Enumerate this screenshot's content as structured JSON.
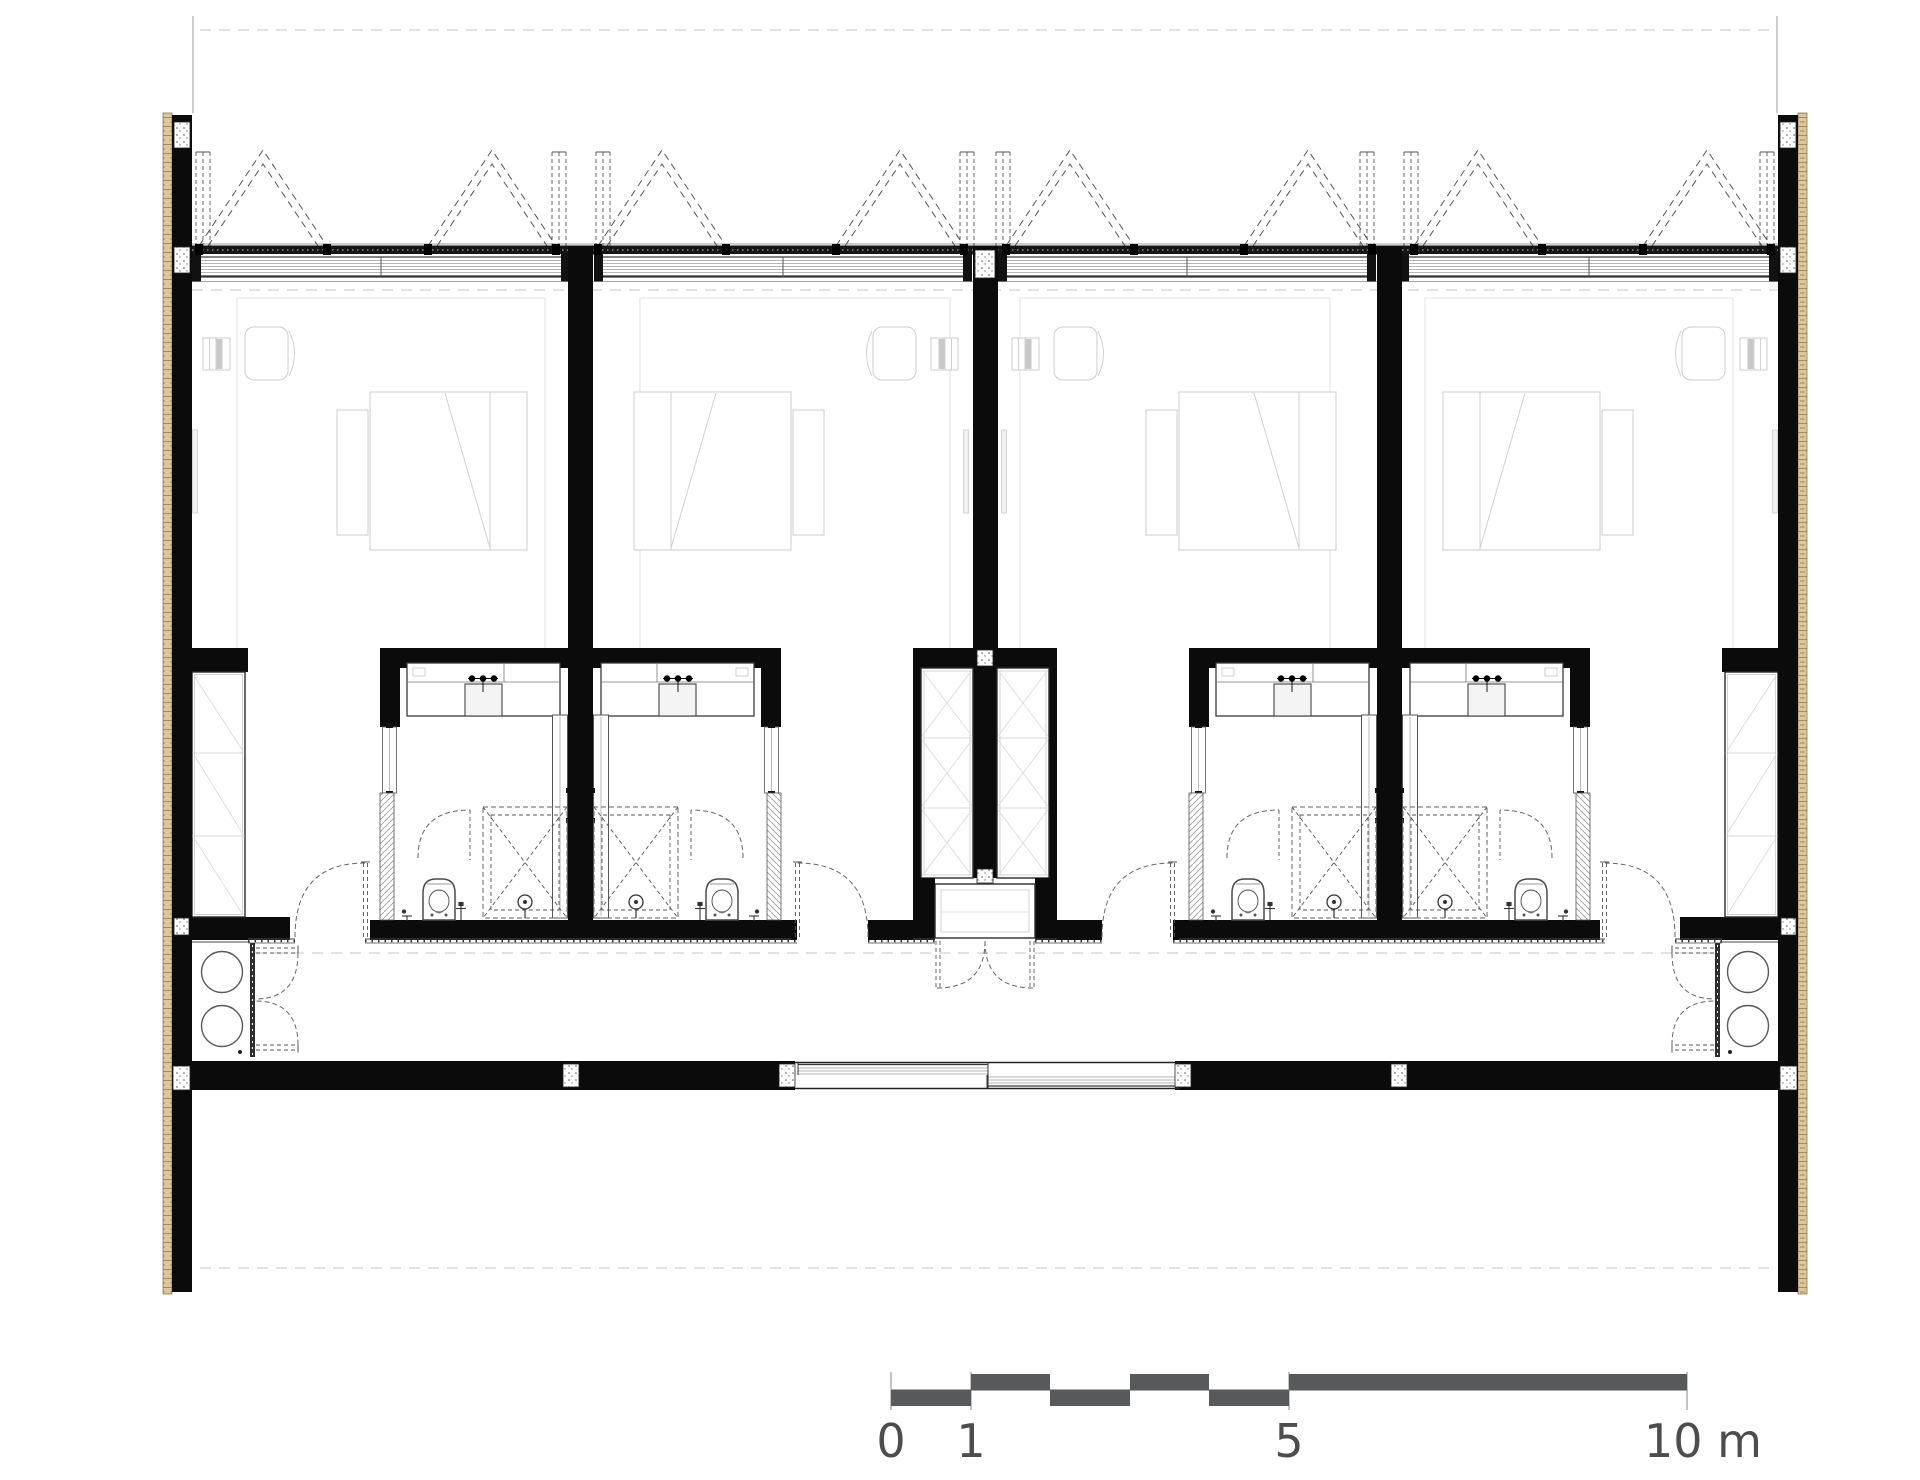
{
  "page": {
    "background": "#ffffff",
    "type": "architectural floor plan drawing"
  },
  "plan": {
    "units": 4,
    "rooms_per_unit": [
      "bedroom",
      "bathroom"
    ],
    "shared_spaces": [
      "corridor",
      "entrance-vestibule",
      "service-shafts",
      "utility-closets"
    ]
  },
  "scale_bar": {
    "zero": "0",
    "one": "1",
    "five": "5",
    "ten": "10 m"
  },
  "colors": {
    "wall_black": "#0b0b0b",
    "cladding_tan": "#dcc79e",
    "scale_bar": "#58595b",
    "label_text": "#4d4d4d",
    "furniture_line": "#cdcdcd",
    "fixture_line": "#4a4a4a"
  }
}
